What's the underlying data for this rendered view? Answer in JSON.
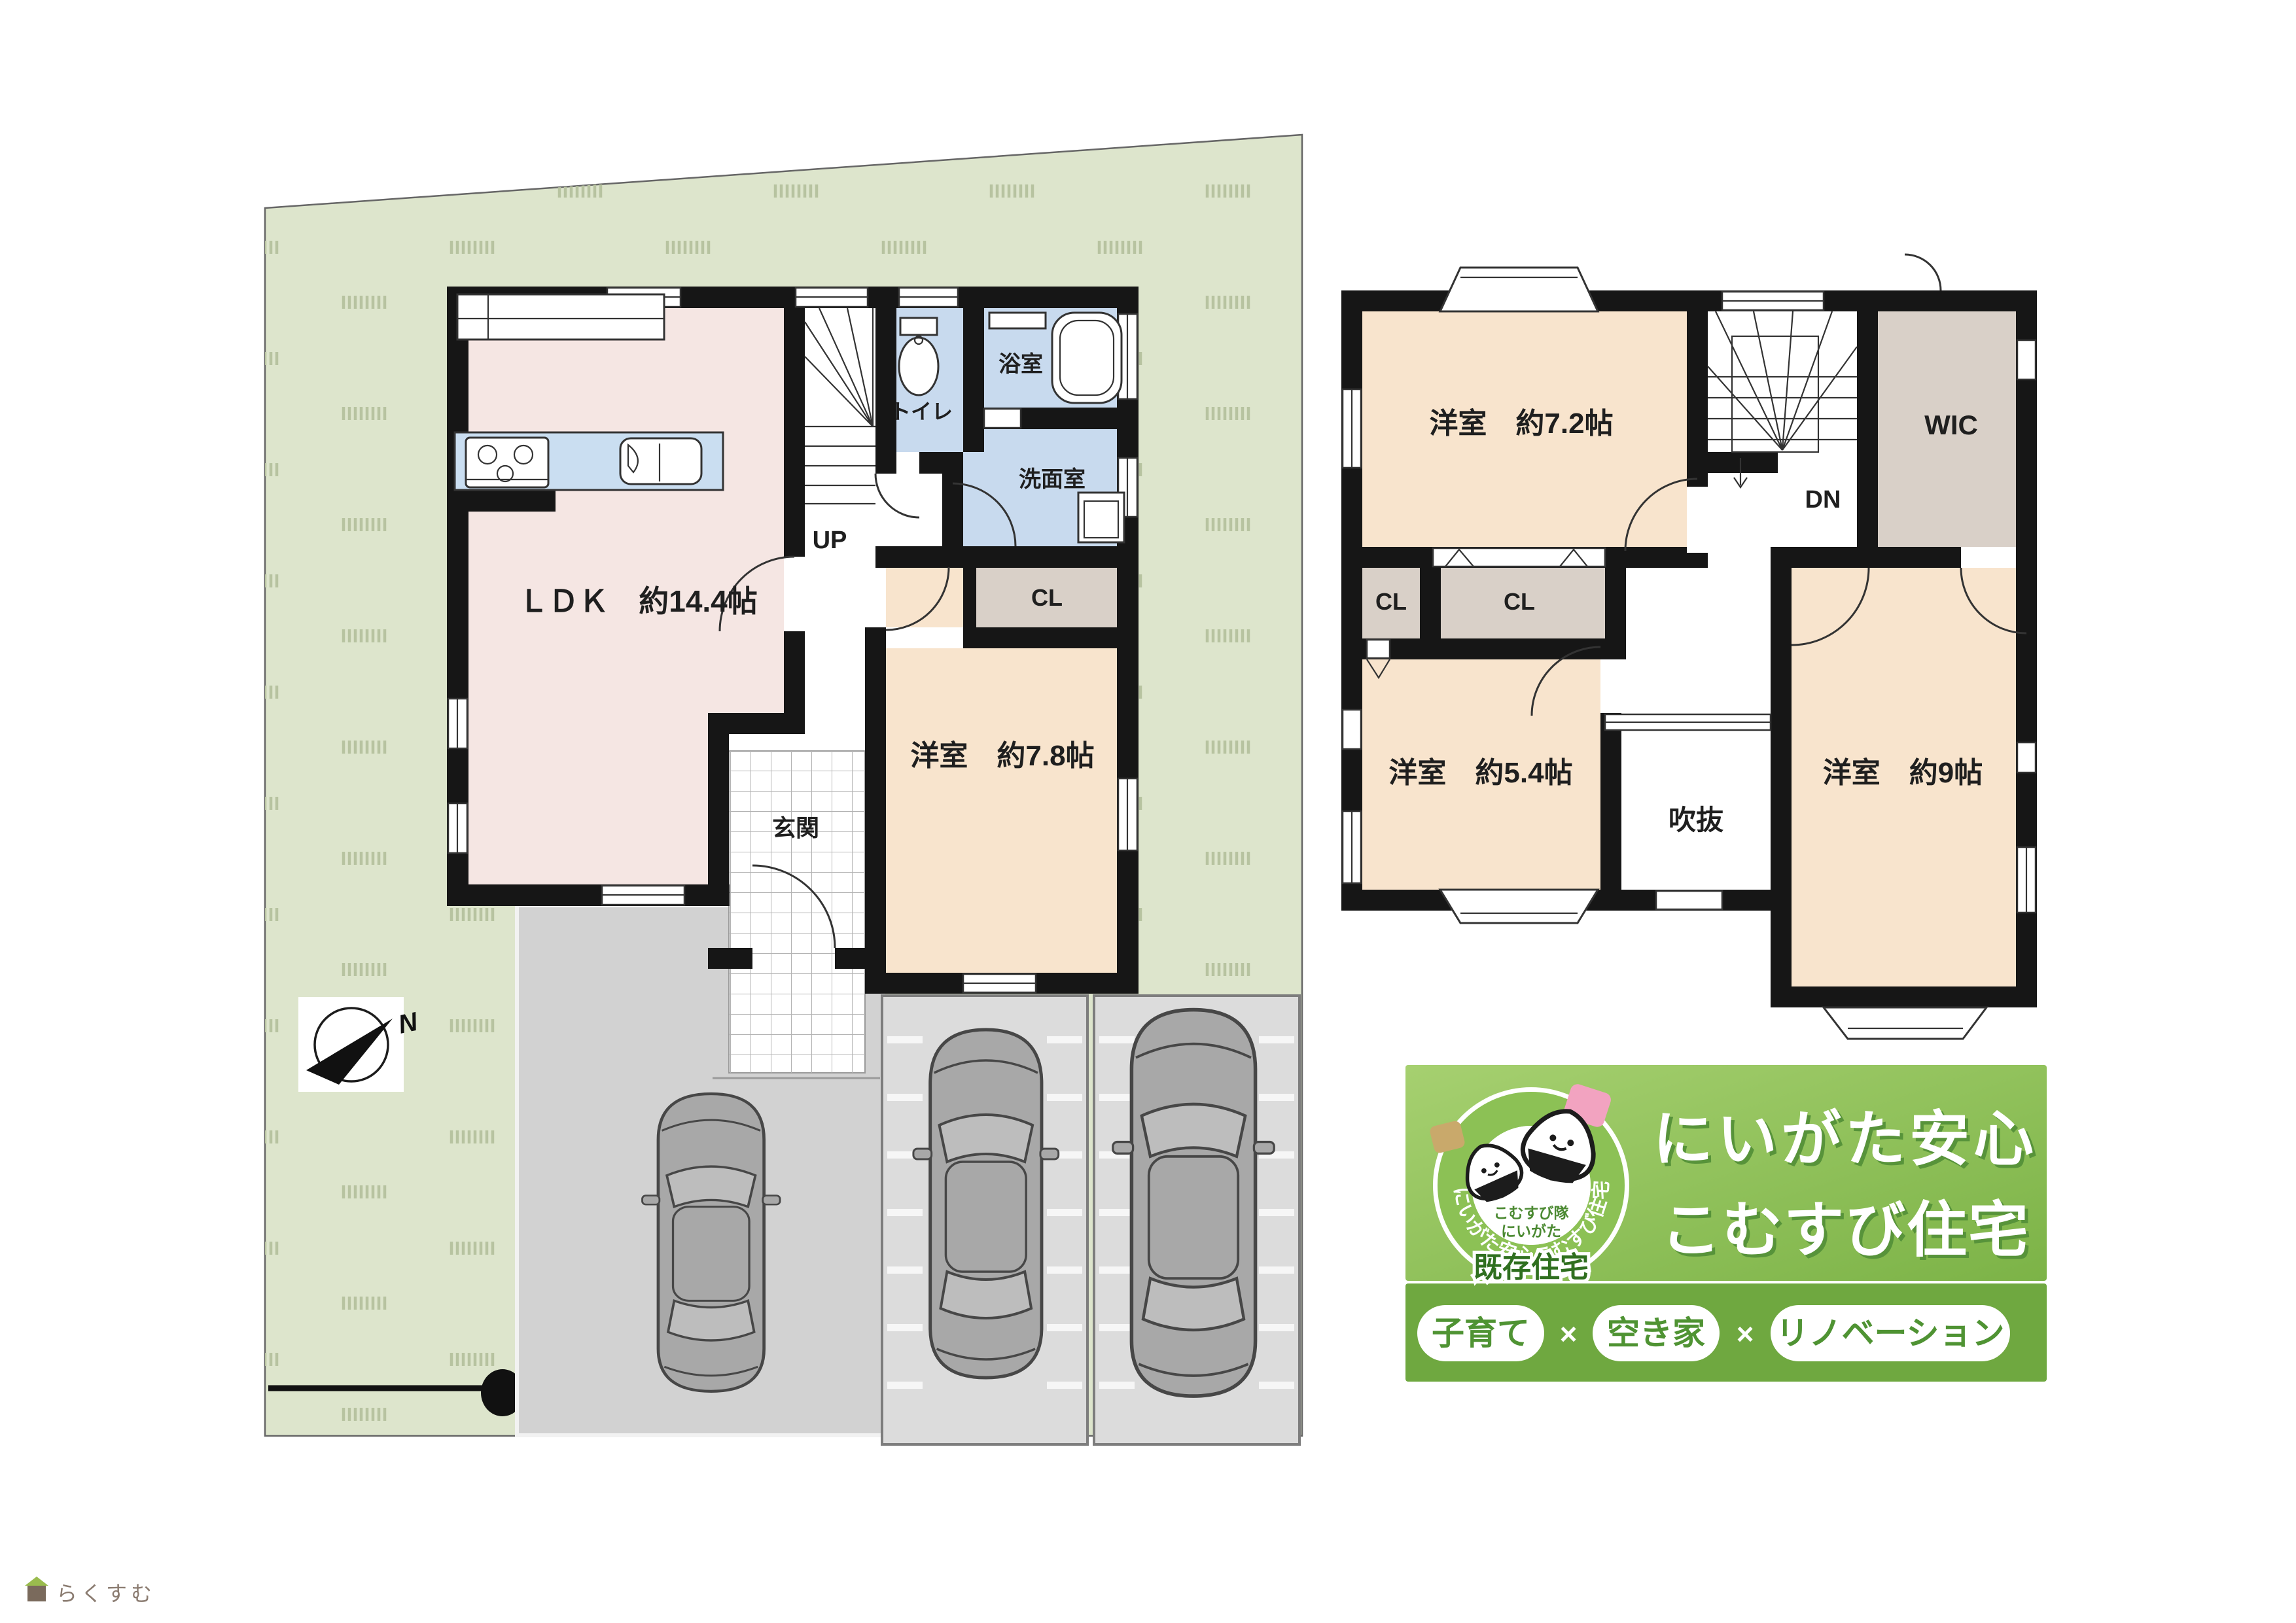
{
  "colors": {
    "lot_green": "#dde5cc",
    "grass": "#b7c3a0",
    "wall": "#161616",
    "ldk_fill": "#f5e6e3",
    "room_fill": "#f8e4cd",
    "closet_fill": "#d9d0c8",
    "wet_fill": "#c8daee",
    "counter_fill": "#cadef1",
    "driveway": "#d2d2d2",
    "pad": "#dcdcdc",
    "banner_green": "#8cc155",
    "banner_dark": "#6fa840",
    "pill_text": "#4f9333",
    "badge_green": "#2f6f1f",
    "title_shadow": "#57933a",
    "onigiri_pink": "#f2a3c0",
    "onigiri_tan": "#c9a96b",
    "watermark_text": "#8a7b70"
  },
  "floor1": {
    "ldk": "ＬＤＫ　約14.4帖",
    "room78": "洋室　約7.8帖",
    "genkan": "玄関",
    "up": "UP",
    "toilet": "トイレ",
    "bath": "浴室",
    "washroom": "洗面室",
    "closet": "CL"
  },
  "floor2": {
    "room72": "洋室　約7.2帖",
    "wic": "WIC",
    "dn": "DN",
    "closet1": "CL",
    "closet2": "CL",
    "room54": "洋室　約5.4帖",
    "void": "吹抜",
    "room9": "洋室　約9帖"
  },
  "compass": {
    "north": "N"
  },
  "banner": {
    "title_line1": "にいがた安心",
    "title_line2": "こむすび住宅",
    "ring_text": "にいがた安心こむすび住宅",
    "logo_sub1": "こむすび隊",
    "logo_sub2": "にいがた",
    "badge": "既存住宅",
    "pill1": "子育て",
    "x1": "×",
    "pill2": "空き家",
    "x2": "×",
    "pill3": "リノベーション"
  },
  "watermark": "らくすむ"
}
